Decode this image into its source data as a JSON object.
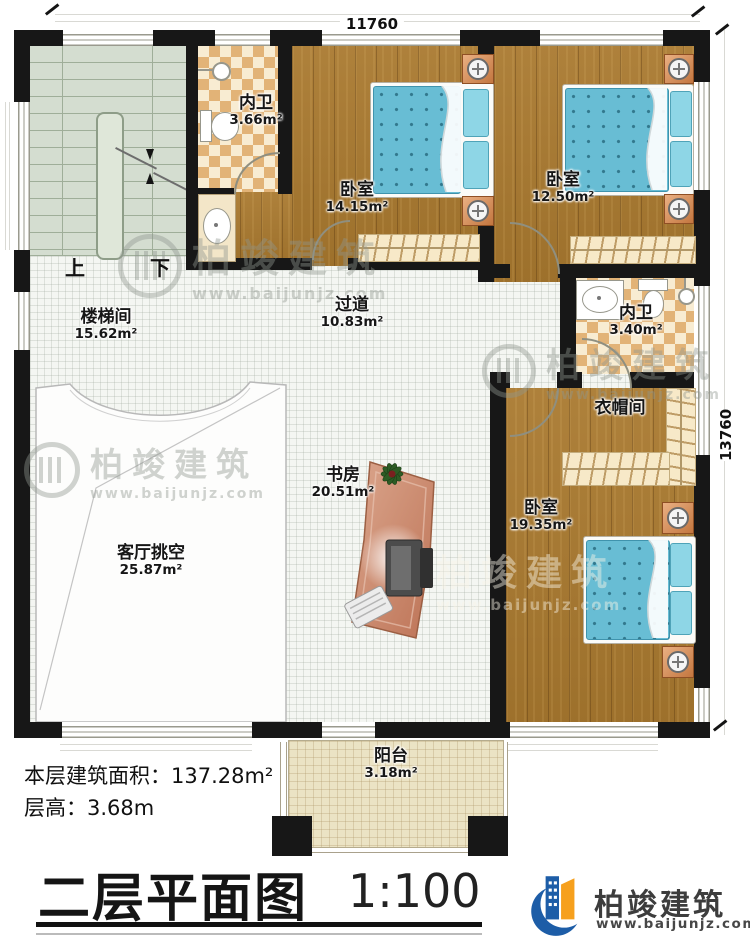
{
  "meta": {
    "title": "二层平面图",
    "scale": "1:100"
  },
  "dimensions": {
    "width_mm": "11760",
    "height_mm": "13760"
  },
  "stats": {
    "area_label": "本层建筑面积：",
    "area_value": "137.28m²",
    "height_label": "层高：",
    "height_value": "3.68m"
  },
  "brand": {
    "name": "柏竣建筑",
    "url": "www.baijunjz.com"
  },
  "stairs": {
    "up": "上",
    "down": "下"
  },
  "rooms": {
    "stairwell": {
      "name": "楼梯间",
      "area": "15.62m²"
    },
    "bath1": {
      "name": "内卫",
      "area": "3.66m²"
    },
    "bedroom1": {
      "name": "卧室",
      "area": "14.15m²"
    },
    "bedroom2": {
      "name": "卧室",
      "area": "12.50m²"
    },
    "hallway": {
      "name": "过道",
      "area": "10.83m²"
    },
    "bath2": {
      "name": "内卫",
      "area": "3.40m²"
    },
    "cloakroom": {
      "name": "衣帽间",
      "area": ""
    },
    "study": {
      "name": "书房",
      "area": "20.51m²"
    },
    "living_void": {
      "name": "客厅挑空",
      "area": "25.87m²"
    },
    "bedroom3": {
      "name": "卧室",
      "area": "19.35m²"
    },
    "balcony": {
      "name": "阳台",
      "area": "3.18m²"
    }
  },
  "colors": {
    "wall": "#171717",
    "wood": "#a9792f",
    "checker": "#e2b377",
    "stair": "#d4ddd0",
    "hall": "#f4f6f2",
    "balcony": "#ebe3c4",
    "bed": "#68bdd4",
    "brand_blue": "#1d5da7",
    "brand_orange": "#f6a01d"
  }
}
